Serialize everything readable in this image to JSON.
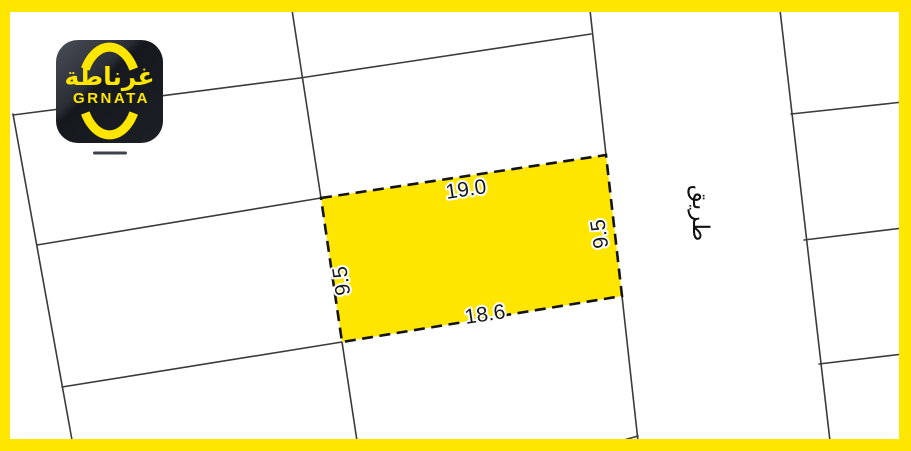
{
  "branding": {
    "logo_arabic": "غرناطة",
    "logo_latin": "GRNATA"
  },
  "plot": {
    "dimensions": {
      "top": "19.0",
      "bottom": "18.6",
      "left": "9.5",
      "right": "9.5"
    }
  },
  "road_label": "طريق",
  "colors": {
    "frame": "#FFE600",
    "plot_fill": "#FFE600",
    "boundary_line": "#3B3B3B",
    "plot_outline": "#141414",
    "dimension_text": "#1A1A1A",
    "logo_background": "#1B1E24",
    "logo_accent": "#FFE600"
  }
}
